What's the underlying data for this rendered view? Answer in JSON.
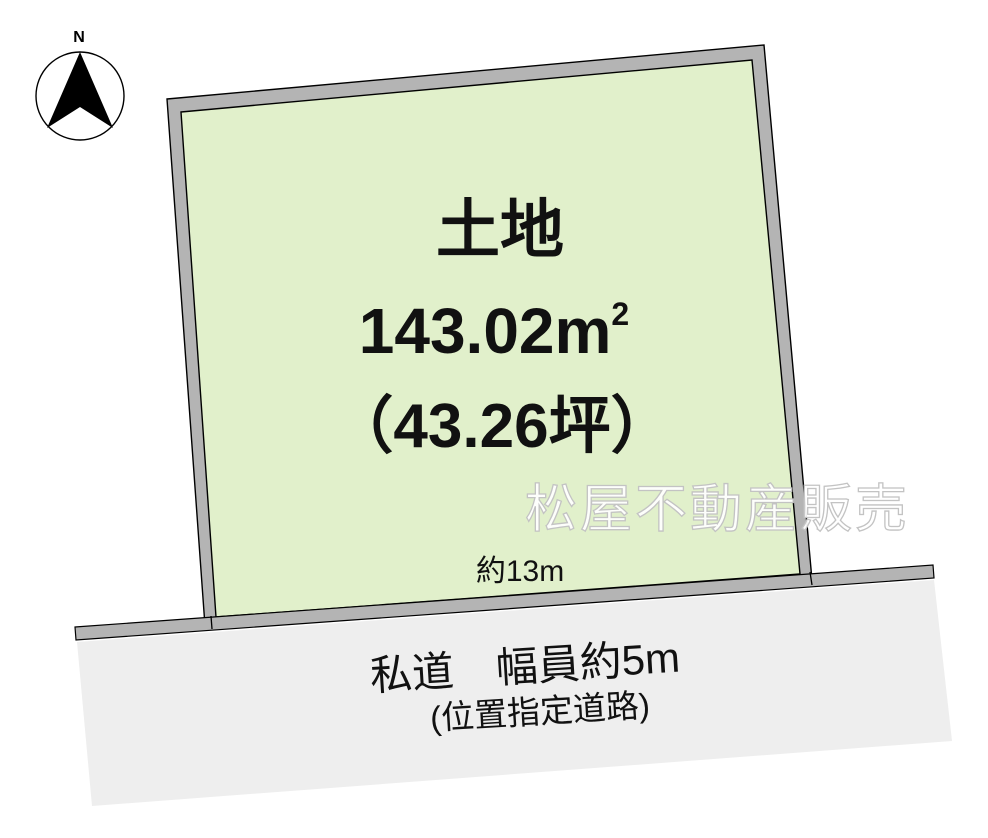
{
  "compass": {
    "north_label": "N"
  },
  "parcel": {
    "title": "土地",
    "area_value": "143.02",
    "area_unit": "m",
    "area_exponent": "2",
    "area_tsubo": "（43.26坪）",
    "frontage": "約13m"
  },
  "road": {
    "name": "私道　幅員約5m",
    "type": "(位置指定道路)"
  },
  "watermark": "松屋不動産販売",
  "colors": {
    "parcel_fill": "#e1f0cb",
    "band_gray": "#b4b4b4",
    "road_fill": "#eeeeee",
    "outline": "#000000",
    "compass_fill": "#ffffff"
  }
}
